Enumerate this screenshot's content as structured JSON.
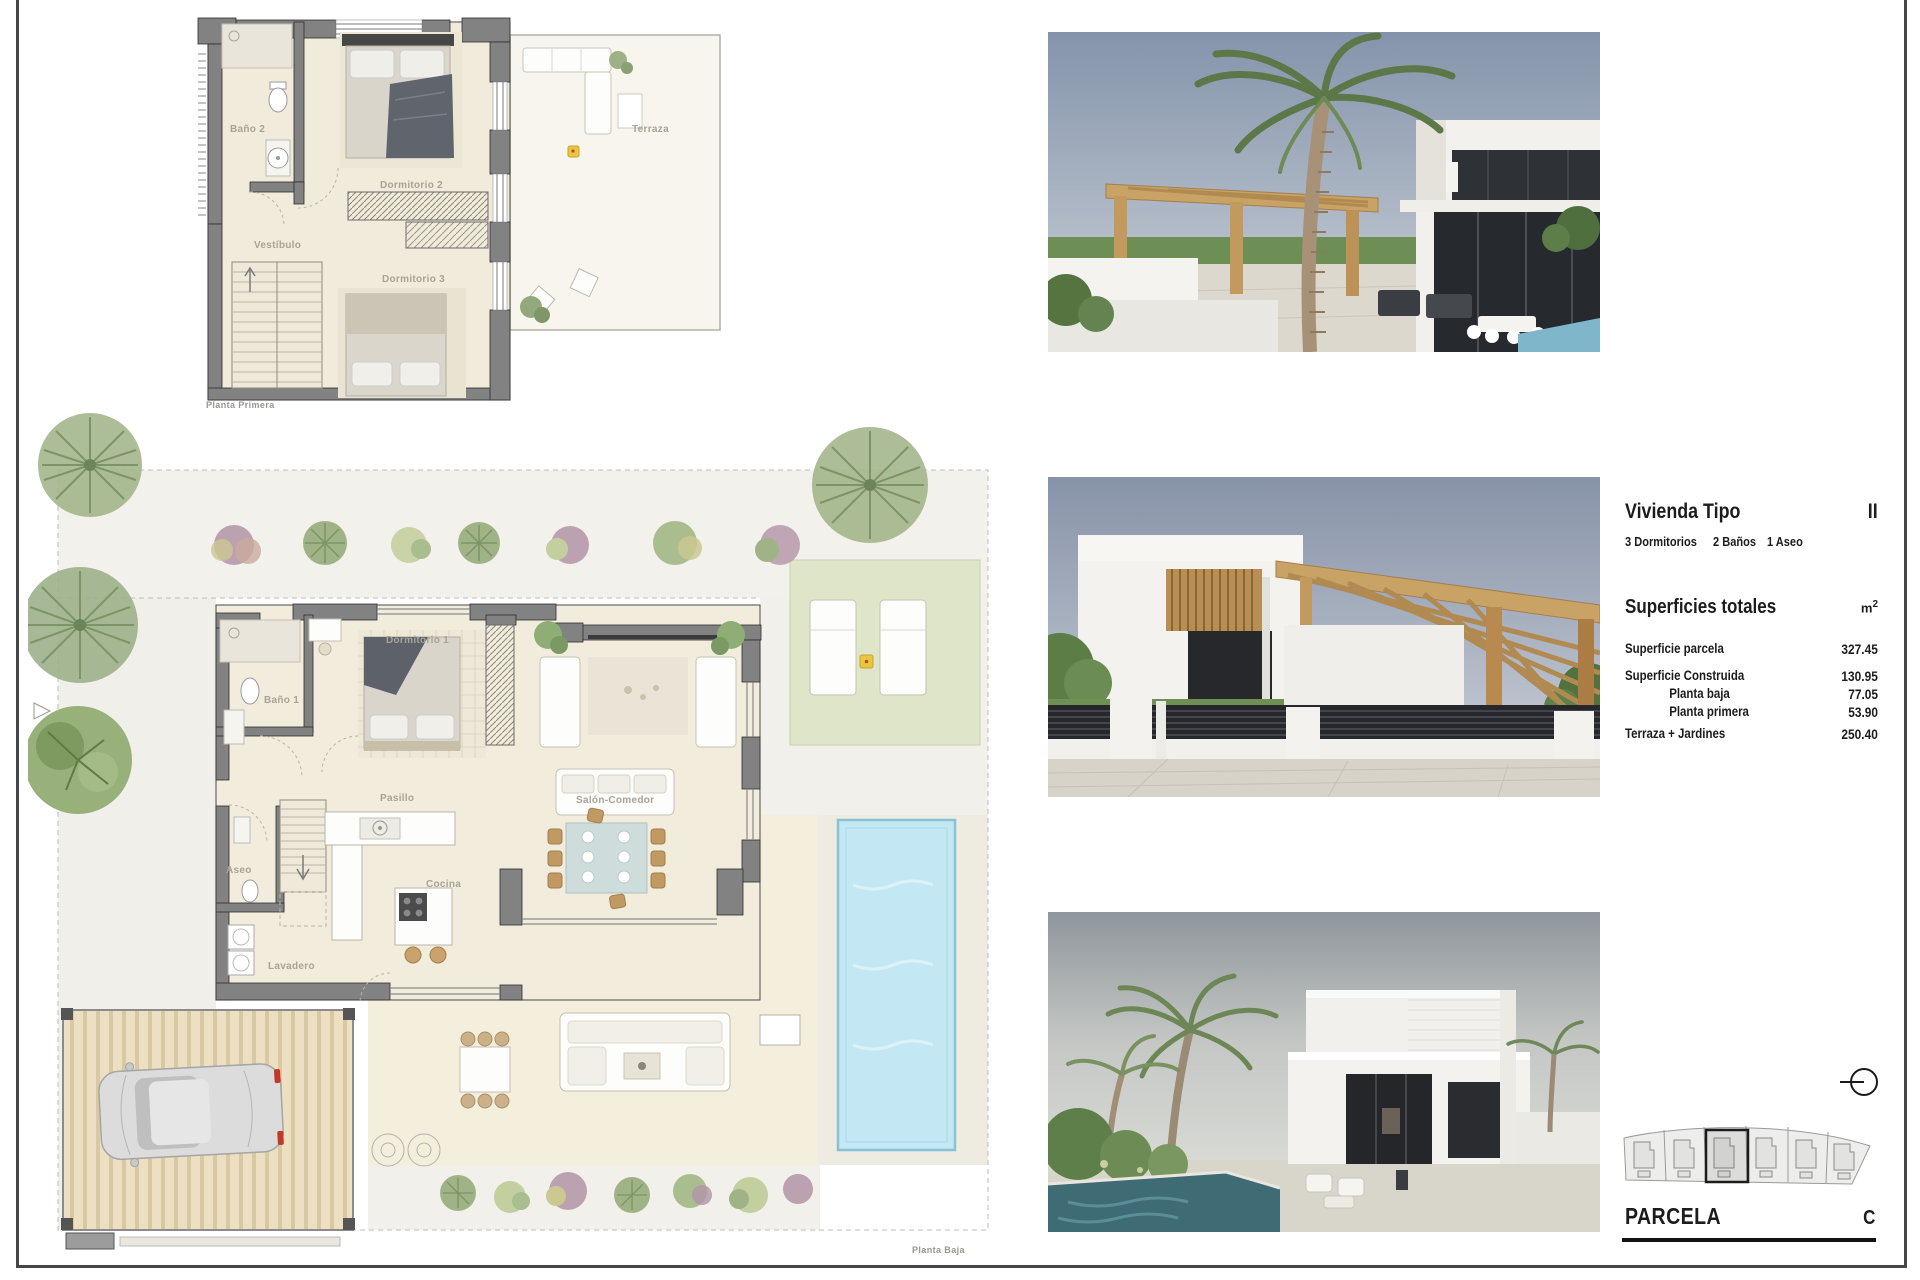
{
  "plans": {
    "planta_primera": {
      "caption": "Planta Primera",
      "rooms": {
        "bano2": "Baño 2",
        "dormitorio2": "Dormitorio 2",
        "vestibulo": "Vestíbulo",
        "dormitorio3": "Dormitorio 3",
        "terraza": "Terraza"
      }
    },
    "planta_baja": {
      "caption": "Planta Baja",
      "rooms": {
        "bano1": "Baño 1",
        "dormitorio1": "Dormitorio 1",
        "pasillo": "Pasillo",
        "salon": "Salón-Comedor",
        "aseo": "Aseo",
        "cocina": "Cocina",
        "lavadero": "Lavadero"
      }
    }
  },
  "info_panel": {
    "title": "Vivienda Tipo",
    "type_code": "II",
    "features": [
      "3 Dormitorios",
      "2 Baños",
      "1 Aseo"
    ],
    "surfaces": {
      "title": "Superficies totales",
      "unit": "m",
      "unit_exp": "2",
      "rows": [
        {
          "label": "Superficie parcela",
          "value": "327.45"
        },
        {
          "label": "Superficie Construida",
          "value": "130.95"
        },
        {
          "label": "Planta baja",
          "value": "77.05"
        },
        {
          "label": "Planta primera",
          "value": "53.90"
        },
        {
          "label": "Terraza + Jardines",
          "value": "250.40"
        }
      ]
    }
  },
  "parcel": {
    "label": "PARCELA",
    "code": "C"
  },
  "colors": {
    "wall": "#828282",
    "floor": "#f1ebdc",
    "terrace": "#f7f5ee",
    "lawn": "#dfe5c8",
    "pool": "#c3e8f3",
    "wood": "#c9a265",
    "accent_yellow": "#eac63e",
    "border": "#454747"
  }
}
